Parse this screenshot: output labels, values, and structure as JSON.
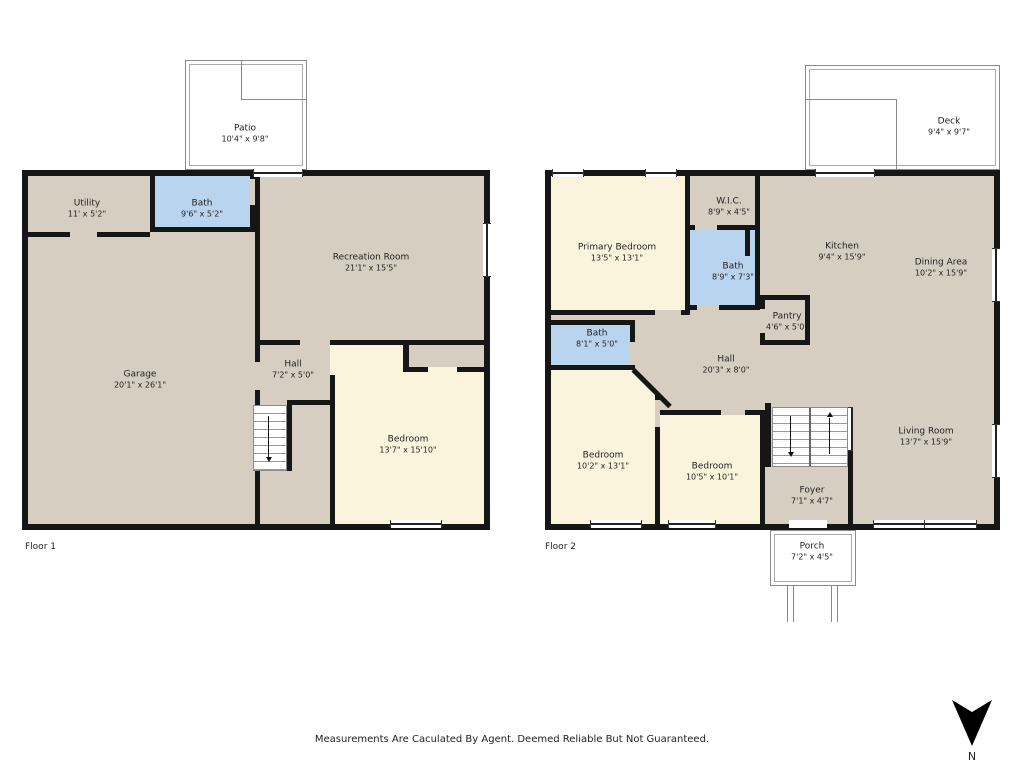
{
  "page": {
    "disclaimer": "Measurements Are Caculated By Agent. Deemed Reliable But Not Guaranteed.",
    "north_label": "N"
  },
  "colors": {
    "beige": "#d6cec0",
    "cream": "#fbf4dc",
    "blue": "#b9d4ee",
    "wall": "#161616",
    "line": "#8a8a8a"
  },
  "floor1": {
    "label": "Floor 1",
    "rooms": {
      "patio": {
        "name": "Patio",
        "dims": "10'4\" x 9'8\""
      },
      "utility": {
        "name": "Utility",
        "dims": "11' x 5'2\""
      },
      "bath": {
        "name": "Bath",
        "dims": "9'6\" x 5'2\""
      },
      "recreation": {
        "name": "Recreation Room",
        "dims": "21'1\" x 15'5\""
      },
      "garage": {
        "name": "Garage",
        "dims": "20'1\" x 26'1\""
      },
      "hall": {
        "name": "Hall",
        "dims": "7'2\" x 5'0\""
      },
      "bedroom": {
        "name": "Bedroom",
        "dims": "13'7\" x 15'10\""
      }
    }
  },
  "floor2": {
    "label": "Floor 2",
    "rooms": {
      "deck": {
        "name": "Deck",
        "dims": "9'4\" x 9'7\""
      },
      "primary_bedroom": {
        "name": "Primary Bedroom",
        "dims": "13'5\" x 13'1\""
      },
      "wic": {
        "name": "W.I.C.",
        "dims": "8'9\" x 4'5\""
      },
      "bath_upper": {
        "name": "Bath",
        "dims": "8'9\" x 7'3\""
      },
      "kitchen": {
        "name": "Kitchen",
        "dims": "9'4\" x 15'9\""
      },
      "dining": {
        "name": "Dining Area",
        "dims": "10'2\" x 15'9\""
      },
      "pantry": {
        "name": "Pantry",
        "dims": "4'6\" x 5'0\""
      },
      "bath_lower": {
        "name": "Bath",
        "dims": "8'1\" x 5'0\""
      },
      "hall": {
        "name": "Hall",
        "dims": "20'3\" x 8'0\""
      },
      "bedroom_left": {
        "name": "Bedroom",
        "dims": "10'2\" x 13'1\""
      },
      "bedroom_right": {
        "name": "Bedroom",
        "dims": "10'5\" x 10'1\""
      },
      "living": {
        "name": "Living Room",
        "dims": "13'7\" x 15'9\""
      },
      "foyer": {
        "name": "Foyer",
        "dims": "7'1\" x 4'7\""
      },
      "porch": {
        "name": "Porch",
        "dims": "7'2\" x 4'5\""
      }
    }
  }
}
